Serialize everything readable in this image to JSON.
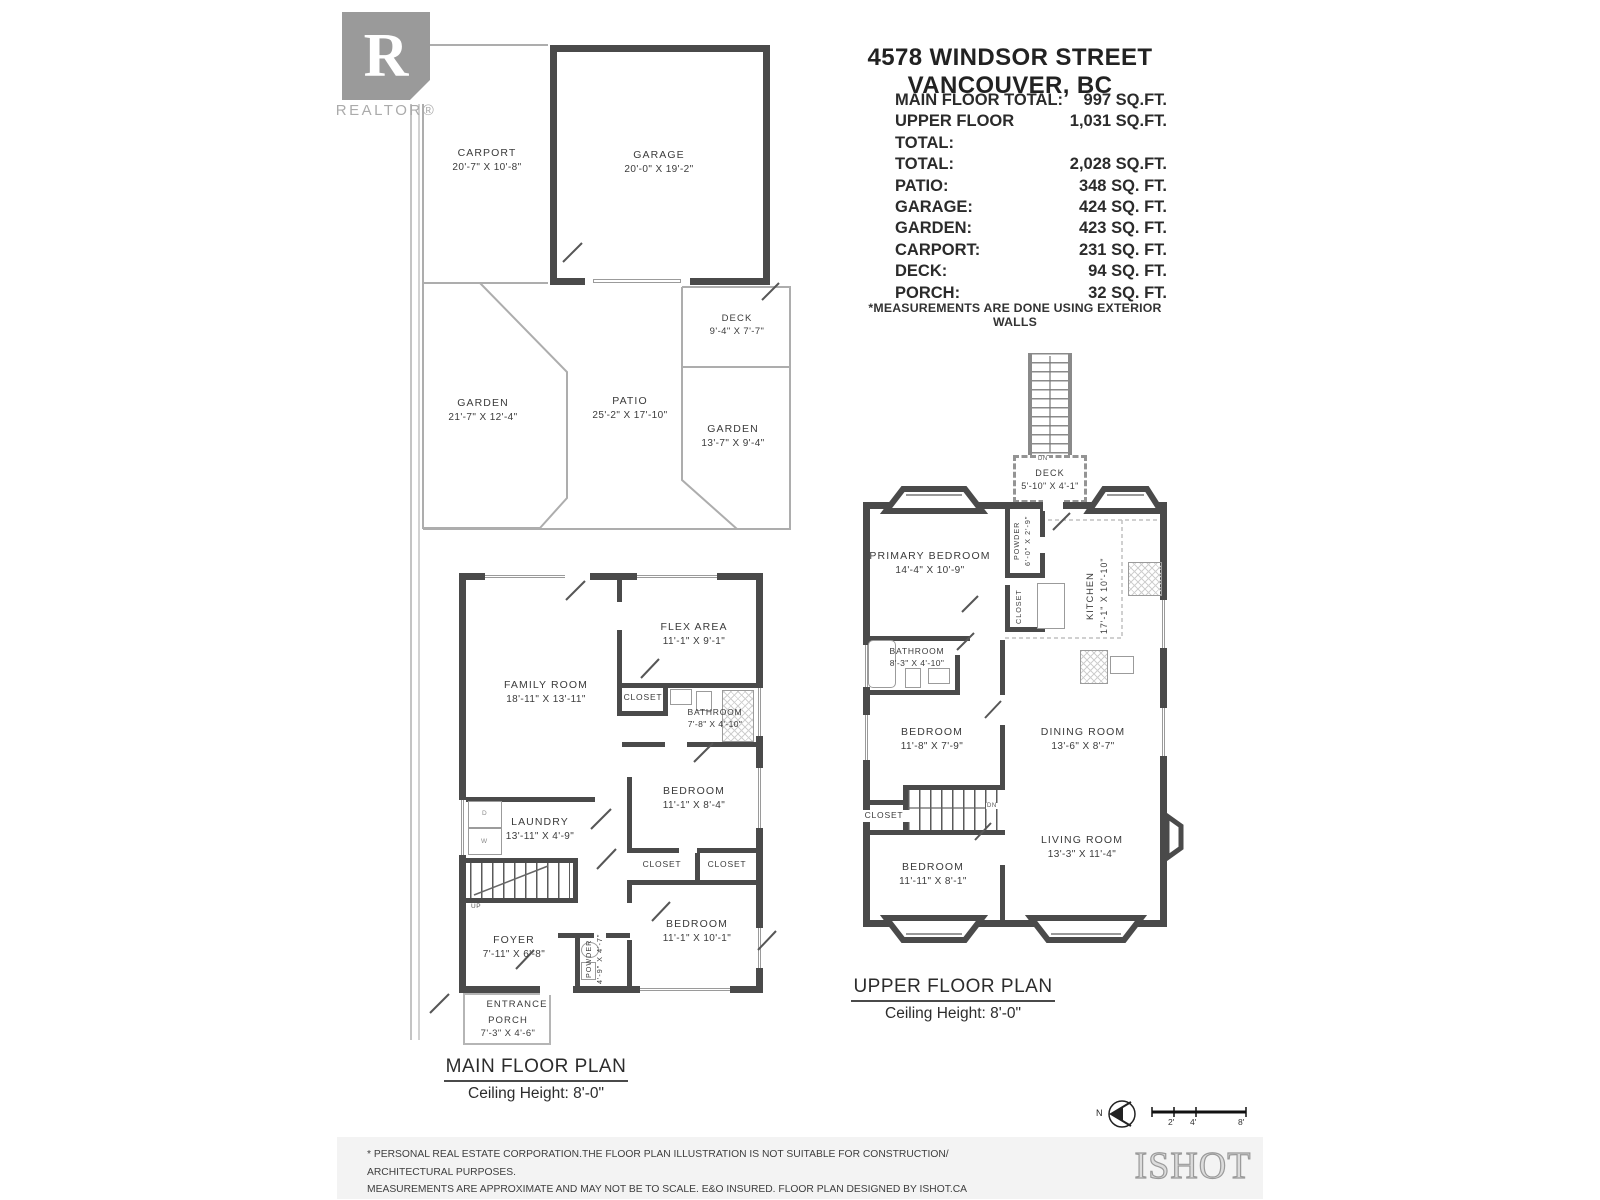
{
  "header": {
    "logo_letter": "R",
    "logo_caption": "REALTOR®",
    "title": "4578 WINDSOR STREET VANCOUVER, BC",
    "note": "*MEASUREMENTS ARE DONE USING EXTERIOR WALLS",
    "summary_rows": [
      {
        "label": "MAIN FLOOR TOTAL:",
        "value": "997 SQ.FT."
      },
      {
        "label": "UPPER FLOOR TOTAL:",
        "value": "1,031 SQ.FT."
      },
      {
        "label": "TOTAL:",
        "value": "2,028 SQ.FT."
      },
      {
        "label": "PATIO:",
        "value": "348 SQ. FT."
      },
      {
        "label": "GARAGE:",
        "value": "424 SQ. FT."
      },
      {
        "label": "GARDEN:",
        "value": "423 SQ. FT."
      },
      {
        "label": "CARPORT:",
        "value": "231 SQ. FT."
      },
      {
        "label": "DECK:",
        "value": "94 SQ. FT."
      },
      {
        "label": "PORCH:",
        "value": "32 SQ. FT."
      }
    ]
  },
  "outdoor": {
    "carport": {
      "name": "CARPORT",
      "dims": "20'-7\" X 10'-8\""
    },
    "garage": {
      "name": "GARAGE",
      "dims": "20'-0\" X 19'-2\""
    },
    "deck": {
      "name": "DECK",
      "dims": "9'-4\" X 7'-7\""
    },
    "garden_left": {
      "name": "GARDEN",
      "dims": "21'-7\" X 12'-4\""
    },
    "patio": {
      "name": "PATIO",
      "dims": "25'-2\" X 17'-10\""
    },
    "garden_right": {
      "name": "GARDEN",
      "dims": "13'-7\" X 9'-4\""
    }
  },
  "main_floor": {
    "title": "MAIN FLOOR PLAN",
    "subtitle": "Ceiling Height: 8'-0\"",
    "rooms": {
      "family_room": {
        "name": "FAMILY ROOM",
        "dims": "18'-11\" X 13'-11\""
      },
      "flex_area": {
        "name": "FLEX AREA",
        "dims": "11'-1\" X 9'-1\""
      },
      "closet1": {
        "name": "CLOSET"
      },
      "bathroom": {
        "name": "BATHROOM",
        "dims": "7'-8\" X 4'-10\""
      },
      "bedroom1": {
        "name": "BEDROOM",
        "dims": "11'-1\" X 8'-4\""
      },
      "laundry": {
        "name": "LAUNDRY",
        "dims": "13'-11\" X 4'-9\""
      },
      "closet2": {
        "name": "CLOSET"
      },
      "closet3": {
        "name": "CLOSET"
      },
      "foyer": {
        "name": "FOYER",
        "dims": "7'-11\" X 6'-8\""
      },
      "powder": {
        "name": "POWDER",
        "dims": "4'-9\" X 4'-7\""
      },
      "bedroom2": {
        "name": "BEDROOM",
        "dims": "11'-1\" X 10'-1\""
      },
      "entrance": {
        "name": "ENTRANCE"
      },
      "porch": {
        "name": "PORCH",
        "dims": "7'-3\" X 4'-6\""
      }
    },
    "labels": {
      "up": "UP",
      "dryer": "D",
      "washer": "W"
    }
  },
  "upper_floor": {
    "title": "UPPER FLOOR PLAN",
    "subtitle": "Ceiling Height: 8'-0\"",
    "rooms": {
      "deck": {
        "name": "DECK",
        "dims": "5'-10\" X 4'-1\""
      },
      "primary_bedroom": {
        "name": "PRIMARY BEDROOM",
        "dims": "14'-4\" X 10'-9\""
      },
      "powder": {
        "name": "POWDER",
        "dims": "6'-0\" X 2'-9\""
      },
      "closet1": {
        "name": "CLOSET"
      },
      "kitchen": {
        "name": "KITCHEN",
        "dims": "17'-1\" X 10'-10\""
      },
      "bathroom": {
        "name": "BATHROOM",
        "dims": "8'-3\" X 4'-10\""
      },
      "bedroom1": {
        "name": "BEDROOM",
        "dims": "11'-8\" X 7'-9\""
      },
      "dining_room": {
        "name": "DINING ROOM",
        "dims": "13'-6\" X 8'-7\""
      },
      "closet2": {
        "name": "CLOSET"
      },
      "bedroom2": {
        "name": "BEDROOM",
        "dims": "11'-11\" X 8'-1\""
      },
      "living_room": {
        "name": "LIVING ROOM",
        "dims": "13'-3\" X 11'-4\""
      }
    },
    "labels": {
      "dn_deck": "DN",
      "dn_stairs": "DN"
    }
  },
  "footer": {
    "disclaimer_line1": "* PERSONAL REAL ESTATE CORPORATION.THE FLOOR PLAN ILLUSTRATION IS NOT SUITABLE FOR CONSTRUCTION/ ARCHITECTURAL PURPOSES.",
    "disclaimer_line2": "MEASUREMENTS ARE APPROXIMATE AND MAY NOT BE TO SCALE. E&O INSURED. FLOOR PLAN DESIGNED BY ISHOT.CA ENTERPRISES INC.",
    "disclaimer_line3": "604-368-7979  ISHOT.CA",
    "brand": "ISHOT",
    "compass": "N",
    "scale_labels": [
      "2'",
      "4'",
      "8'"
    ]
  },
  "colors": {
    "wall": "#4a4a4a",
    "thin_line": "#adadad",
    "footer_bg": "#f3f3f3",
    "logo_gray": "#9a9a9a"
  }
}
